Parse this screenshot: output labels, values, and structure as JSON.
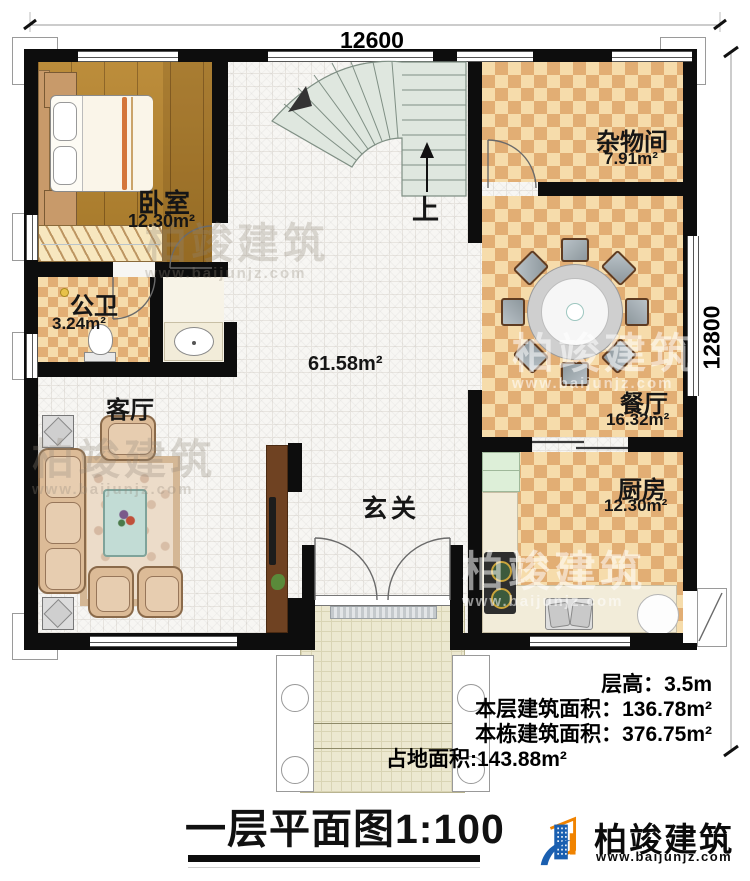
{
  "plan": {
    "dimensions": {
      "top": "12600",
      "right": "12800"
    },
    "rooms": [
      {
        "key": "bedroom",
        "name": "卧室",
        "area": "12.30m²"
      },
      {
        "key": "bathroom",
        "name": "公卫",
        "area": "3.24m²"
      },
      {
        "key": "living",
        "name": "客厅",
        "area": ""
      },
      {
        "key": "hall",
        "name": "",
        "area": "61.58m²"
      },
      {
        "key": "foyer",
        "name": "玄关",
        "area": ""
      },
      {
        "key": "storage",
        "name": "杂物间",
        "area": "7.91m²"
      },
      {
        "key": "dining",
        "name": "餐厅",
        "area": "16.32m²"
      },
      {
        "key": "kitchen",
        "name": "厨房",
        "area": "12.30m²"
      }
    ],
    "stairs": {
      "up_label": "上"
    }
  },
  "info": {
    "lines": [
      {
        "label": "层高：",
        "value": "3.5m"
      },
      {
        "label": "本层建筑面积：",
        "value": "136.78m²"
      },
      {
        "label": "本栋建筑面积：",
        "value": "376.75m²"
      },
      {
        "label": "占地面积:",
        "value": "143.88m²"
      }
    ]
  },
  "title": {
    "text": "一层平面图",
    "scale": "1:100"
  },
  "brand": {
    "name": "柏竣建筑",
    "url": "www.baijunjz.com"
  },
  "watermark": {
    "name": "柏竣建筑",
    "url": "www.baijunjz.com"
  },
  "colors": {
    "wall": "#0d0d0d",
    "checker_light": "#f6dcab",
    "checker_dark": "#e2ae74",
    "wood": "#b8862f",
    "stair": "#dfe7df",
    "brand_blue": "#1a5fb0",
    "brand_orange": "#f08300"
  }
}
